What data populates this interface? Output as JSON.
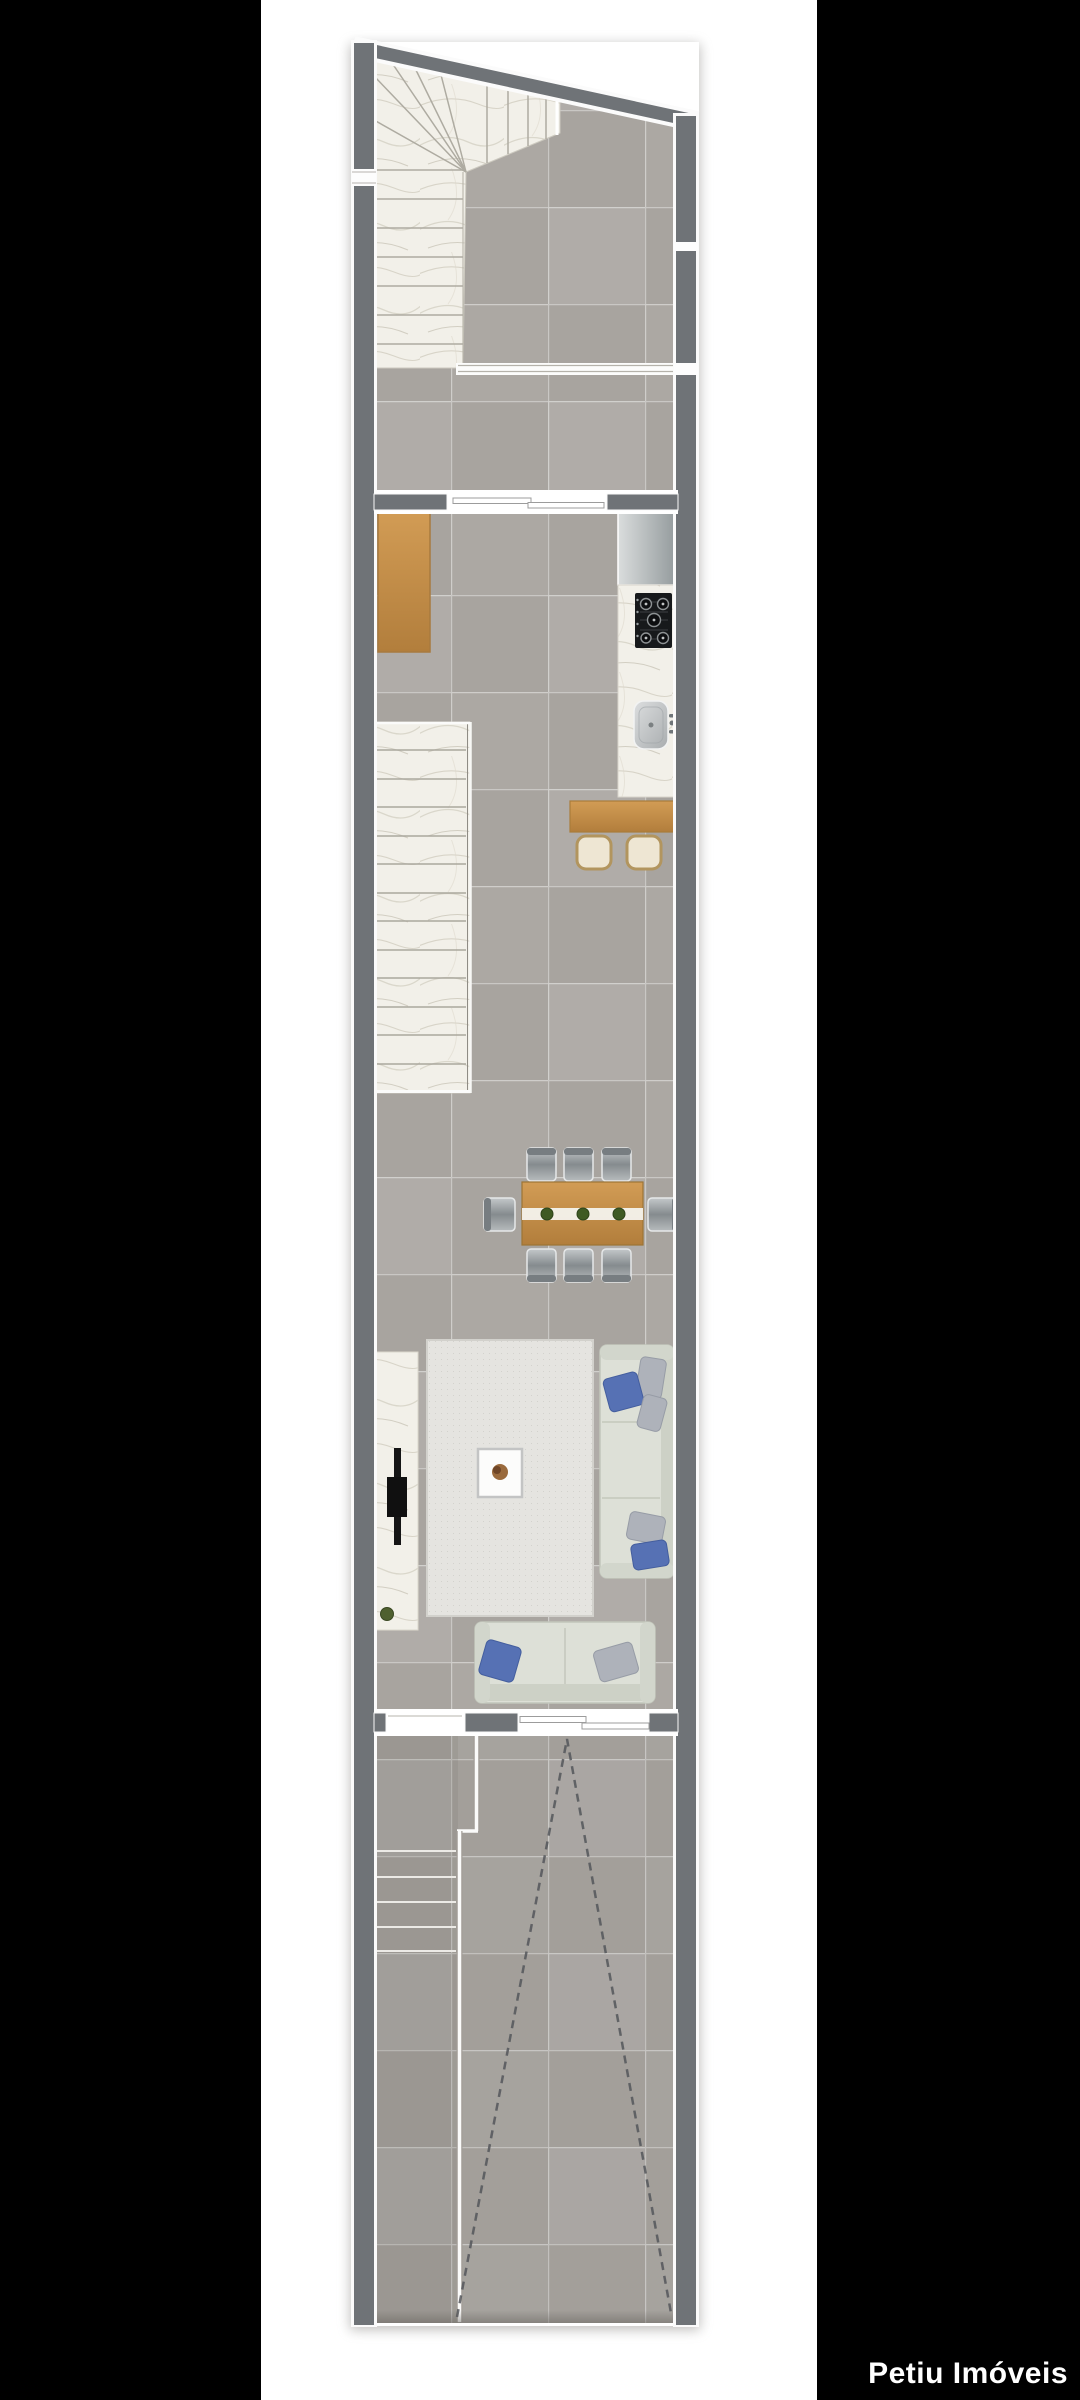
{
  "watermark": {
    "text": "Petiu Imóveis"
  },
  "palette": {
    "background": "#000000",
    "paper": "#ffffff",
    "wall": "#6f7377",
    "wall_outline": "#fafafa",
    "floor_tile": "#aca8a3",
    "tile_grout": "#ffffff",
    "marble": "#f2f0e9",
    "wood_cabinet": "#d59c55",
    "wood_table": "#c9924c",
    "sofa": "#dde0d7",
    "pillow_blue": "#5671b4",
    "pillow_gray": "#aeb2ba",
    "chair_steel": "#9ba1a5",
    "stool_cream": "#eee6d3",
    "rug": "#e5e4e0",
    "cooktop": "#17191b",
    "appliance_steel": "#c6cacc",
    "dashed_marking": "#53565a",
    "plant_green": "#4f6030"
  },
  "floorplan": {
    "type": "residential-townhouse-floor-plan",
    "orientation": "vertical",
    "rooms": [
      "staircase",
      "hall",
      "kitchen",
      "dining-area",
      "living-room",
      "entry-steps",
      "garage"
    ],
    "furniture_counts": {
      "dining_chairs": 8,
      "dining_centerpieces": 3,
      "bar_stools": 2,
      "sofas": 2,
      "stair_flights": 3,
      "sliding_doors": 2
    }
  }
}
